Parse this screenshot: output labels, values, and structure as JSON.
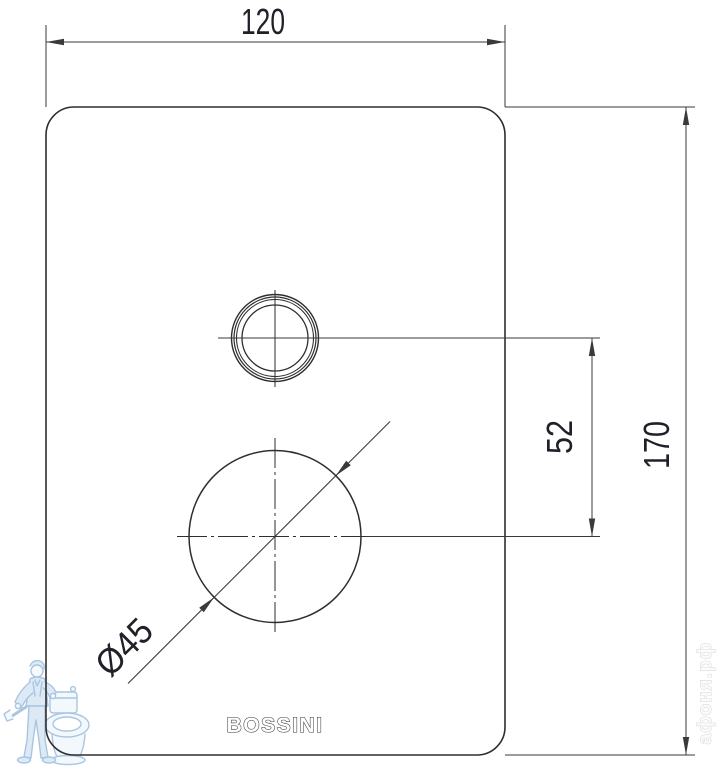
{
  "drawing": {
    "brand": {
      "label": "BOSSINI"
    },
    "dims": {
      "width": {
        "label": "120",
        "value": 120
      },
      "height": {
        "label": "170",
        "value": 170
      },
      "spacing": {
        "label": "52",
        "value": 52
      },
      "diameter": {
        "label": "Ø45",
        "value": 45
      }
    },
    "watermark": {
      "site": "афоня.рф"
    },
    "colors": {
      "line": "#333333",
      "dim_text": "#1f2028",
      "watermark_blue": "#a4c3e1",
      "watermark_gray": "#d2d2d2",
      "background": "#ffffff"
    }
  }
}
